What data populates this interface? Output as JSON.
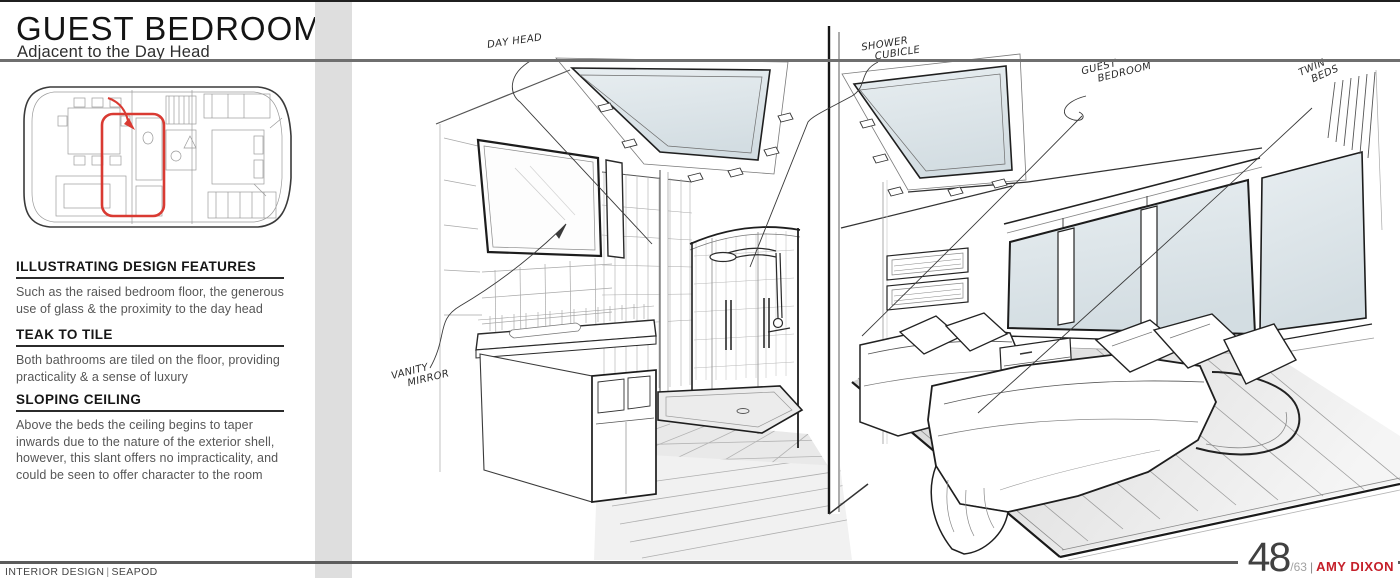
{
  "sidebar": {
    "title": "GUEST BEDROOM",
    "subtitle": "Adjacent to the Day Head",
    "sections": [
      {
        "heading": "ILLUSTRATING DESIGN FEATURES",
        "body": "Such as the raised bedroom floor, the generous use of glass & the proximity to the day head"
      },
      {
        "heading": "TEAK TO TILE",
        "body": "Both bathrooms are tiled on the floor, providing practicality & a sense of luxury"
      },
      {
        "heading": "SLOPING CEILING",
        "body": "Above the beds the ceiling begins to taper inwards due to the nature of the exterior shell, however, this slant offers no impracticality, and could be seen to offer character to the room"
      }
    ]
  },
  "plan": {
    "highlight_color": "#d93a32"
  },
  "sketch": {
    "glass_color": "#dde6ea",
    "annotations": {
      "day_head": {
        "line1": "DAY HEAD",
        "line2": ""
      },
      "shower_cubicle": {
        "line1": "SHOWER",
        "line2": "CUBICLE"
      },
      "guest_bedroom": {
        "line1": "GUEST",
        "line2": "BEDROOM"
      },
      "twin_beds": {
        "line1": "TWIN",
        "line2": "BEDS"
      },
      "vanity_mirror": {
        "line1": "VANITY",
        "line2": "MIRROR"
      }
    }
  },
  "footer": {
    "left_label": "INTERIOR DESIGN",
    "separator": "|",
    "brand": "SEAPOD",
    "page_number": "48",
    "page_total": "/63",
    "author_separator": "|",
    "author": "AMY DIXON",
    "author_color": "#c5202a"
  }
}
